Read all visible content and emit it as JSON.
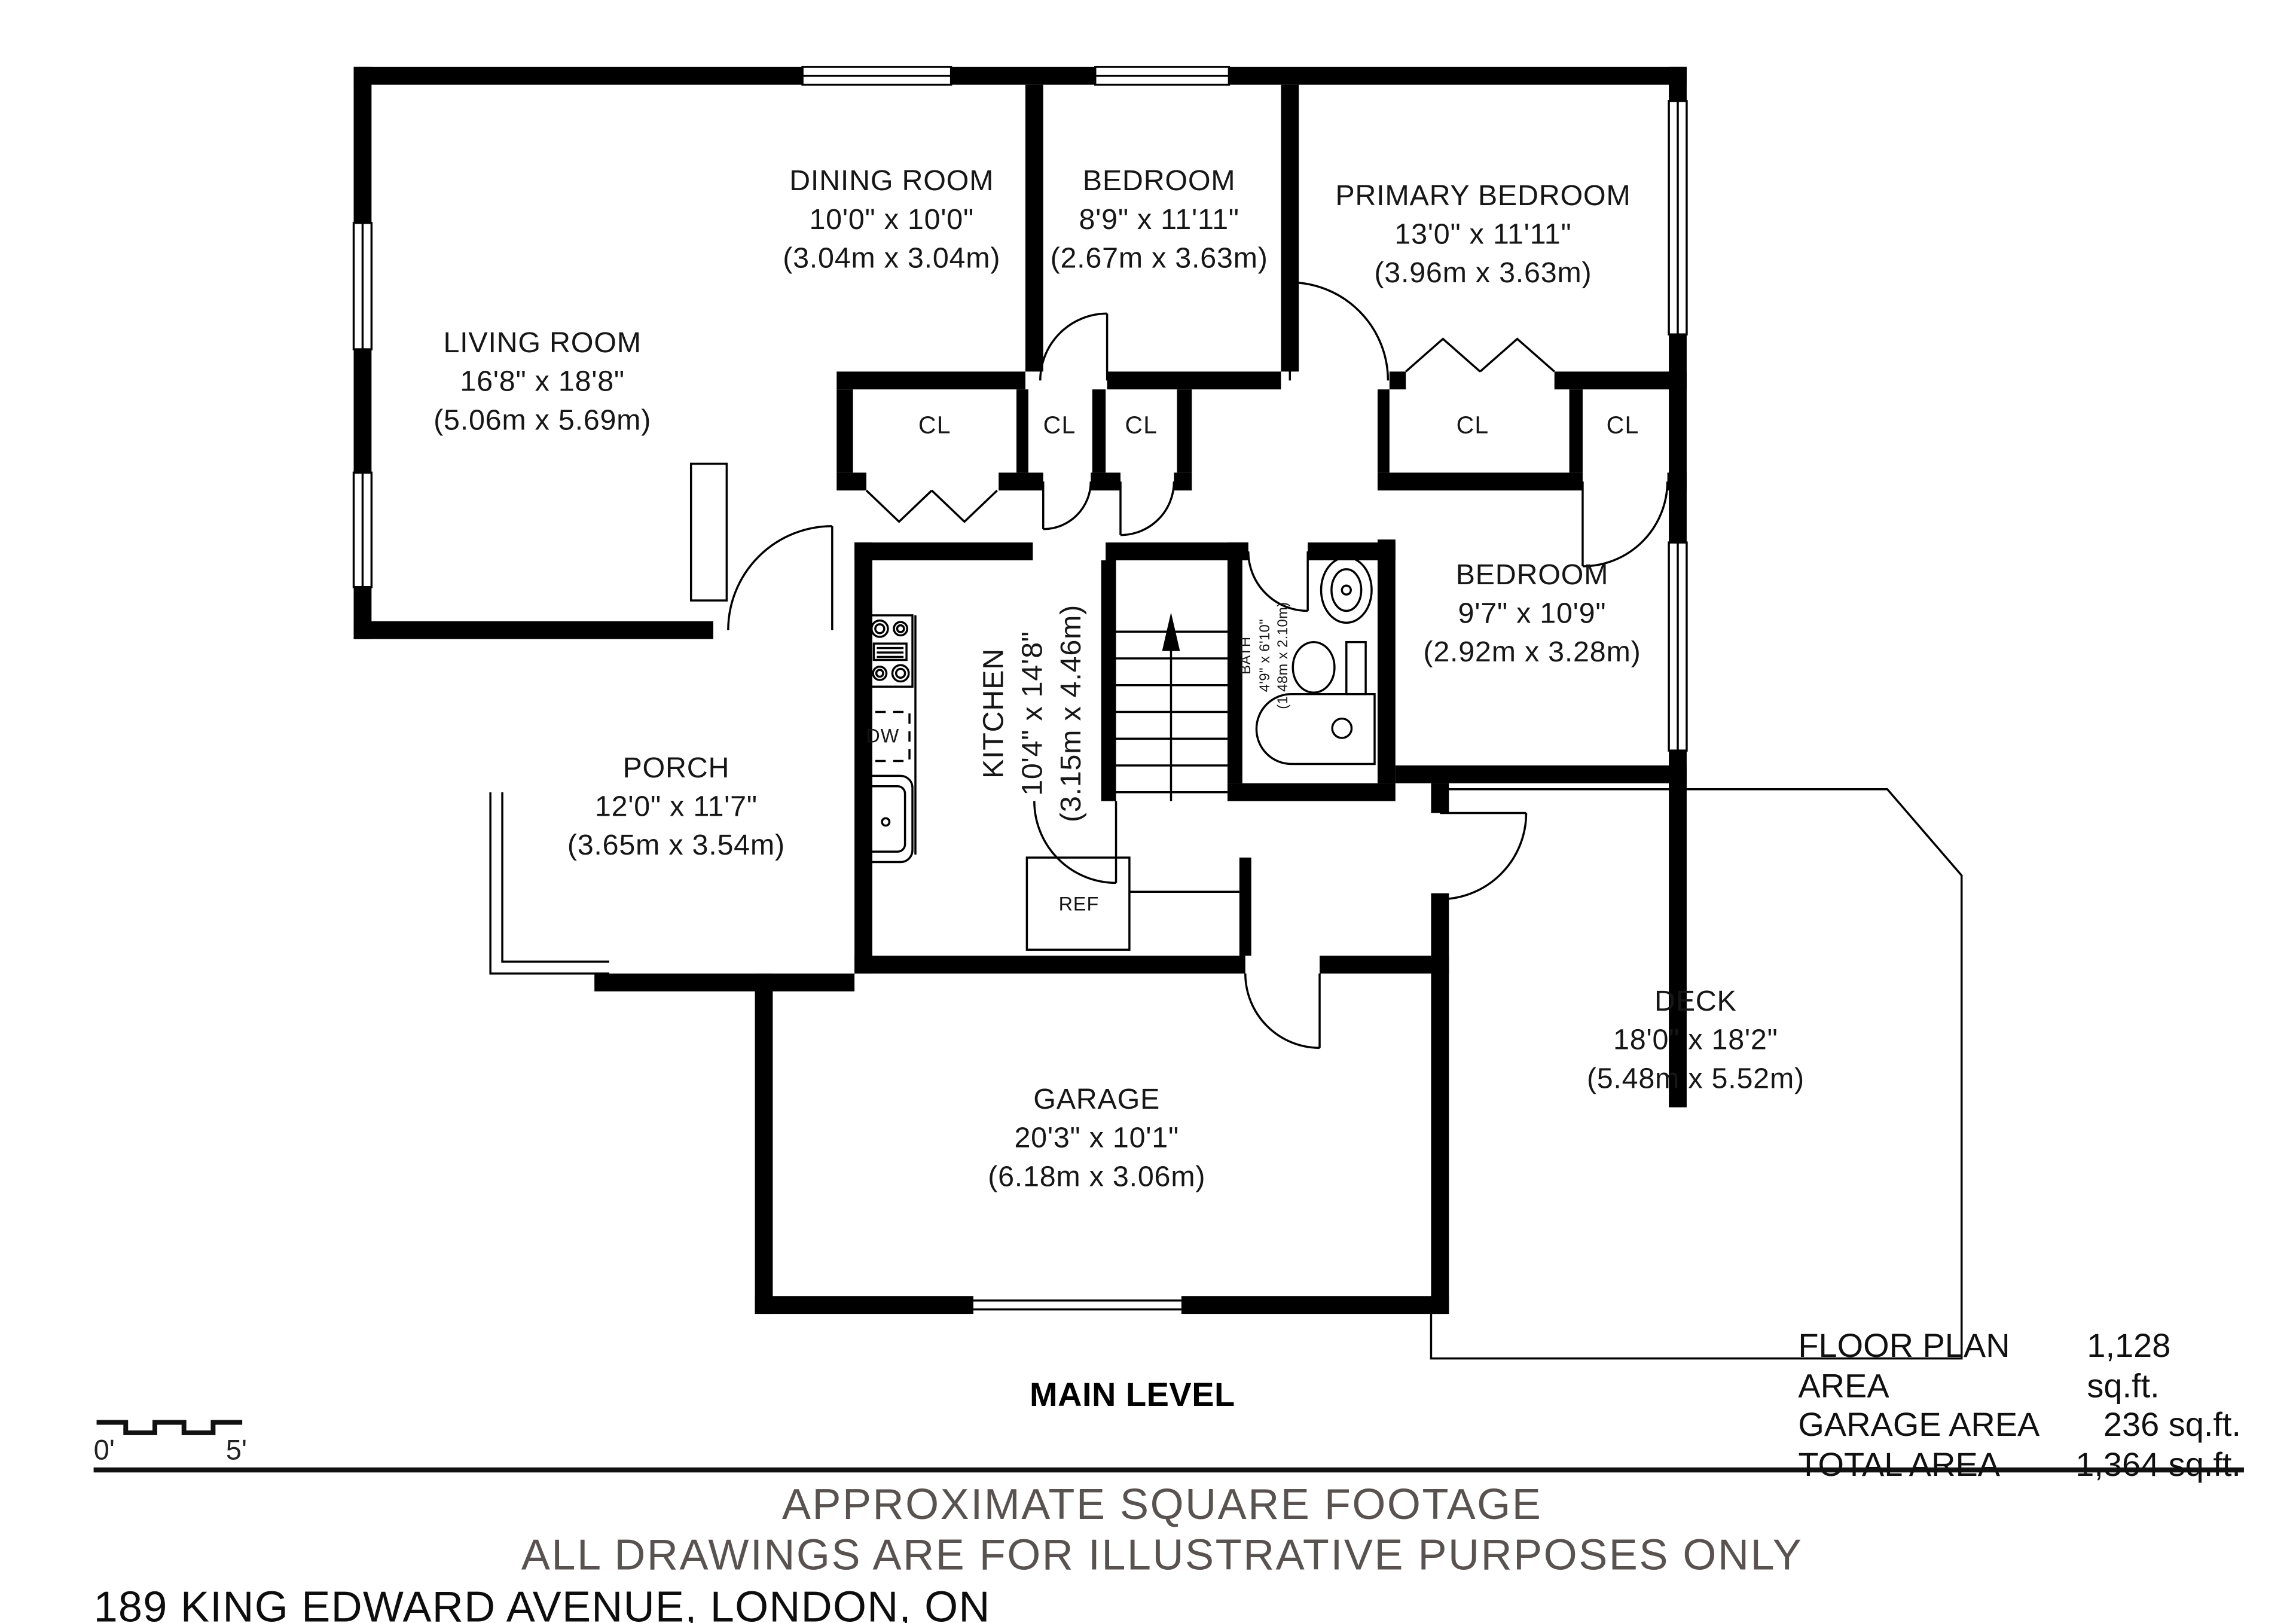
{
  "plan": {
    "rooms": [
      {
        "name": "LIVING ROOM",
        "dims": "16'8\" x 18'8\"",
        "metric": "(5.06m x 5.69m)"
      },
      {
        "name": "DINING ROOM",
        "dims": "10'0\" x 10'0\"",
        "metric": "(3.04m x 3.04m)"
      },
      {
        "name": "BEDROOM",
        "dims": "8'9\" x 11'11\"",
        "metric": "(2.67m x 3.63m)"
      },
      {
        "name": "PRIMARY BEDROOM",
        "dims": "13'0\" x 11'11\"",
        "metric": "(3.96m x 3.63m)"
      },
      {
        "name": "BEDROOM",
        "dims": "9'7\" x 10'9\"",
        "metric": "(2.92m x 3.28m)"
      },
      {
        "name": "KITCHEN",
        "dims": "10'4\" x 14'8\"",
        "metric": "(3.15m x 4.46m)"
      },
      {
        "name": "BATH",
        "dims": "4'9\" x 6'10\"",
        "metric": "(1.48m x 2.10m)"
      },
      {
        "name": "PORCH",
        "dims": "12'0\" x 11'7\"",
        "metric": "(3.65m x 3.54m)"
      },
      {
        "name": "GARAGE",
        "dims": "20'3\" x 10'1\"",
        "metric": "(6.18m x 3.06m)"
      },
      {
        "name": "DECK",
        "dims": "18'0\" x 18'2\"",
        "metric": "(5.48m x 5.52m)"
      }
    ],
    "closet_label": "CL",
    "appliances": {
      "dishwasher": "DW",
      "refrigerator": "REF"
    }
  },
  "scale_bar": {
    "start": "0'",
    "end": "5'"
  },
  "summary": {
    "rows": [
      {
        "label": "FLOOR PLAN AREA",
        "value": "1,128 sq.ft."
      },
      {
        "label": "GARAGE AREA",
        "value": "236 sq.ft."
      },
      {
        "label": "TOTAL AREA",
        "value": "1,364 sq.ft."
      }
    ]
  },
  "level_label": "MAIN LEVEL",
  "notes": {
    "line1": "APPROXIMATE SQUARE FOOTAGE",
    "line2": "ALL DRAWINGS ARE FOR ILLUSTRATIVE PURPOSES ONLY"
  },
  "address": "189 KING EDWARD AVENUE, LONDON, ON"
}
